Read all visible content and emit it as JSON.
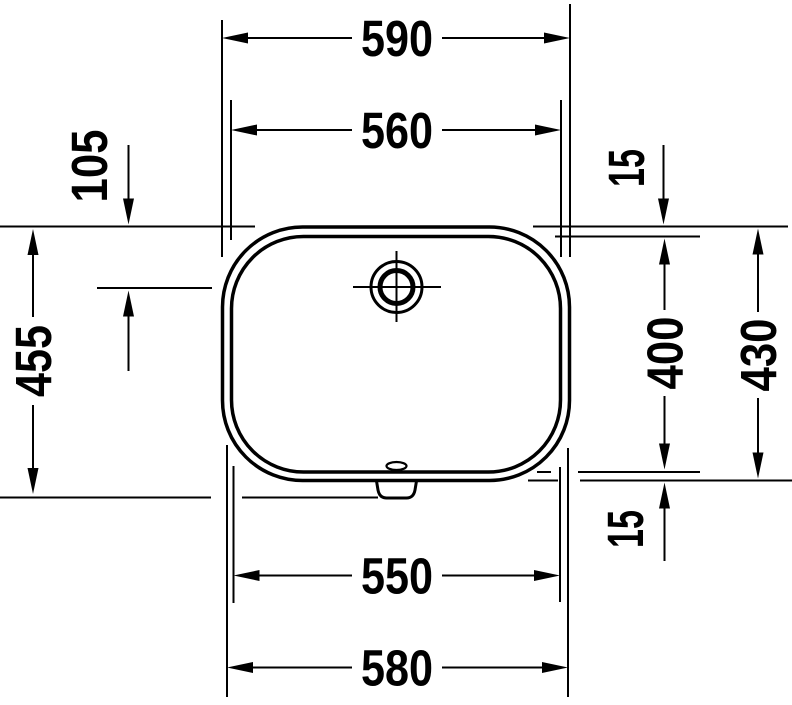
{
  "diagram": {
    "description": "Technical dimension drawing of a washbasin seen from above, with overflow hole and drain outlet",
    "unit": "mm",
    "palette": {
      "line_color": "#000000",
      "background": "#ffffff"
    },
    "dimensions": {
      "outer_width_top": "590",
      "basin_width_top": "560",
      "overflow_offset": "105",
      "rim_overhang_top": "15",
      "overall_depth": "455",
      "basin_depth": "400",
      "outer_depth": "430",
      "rim_overhang_bottom": "15",
      "basin_width_bottom": "550",
      "outer_width_bottom": "580"
    }
  }
}
